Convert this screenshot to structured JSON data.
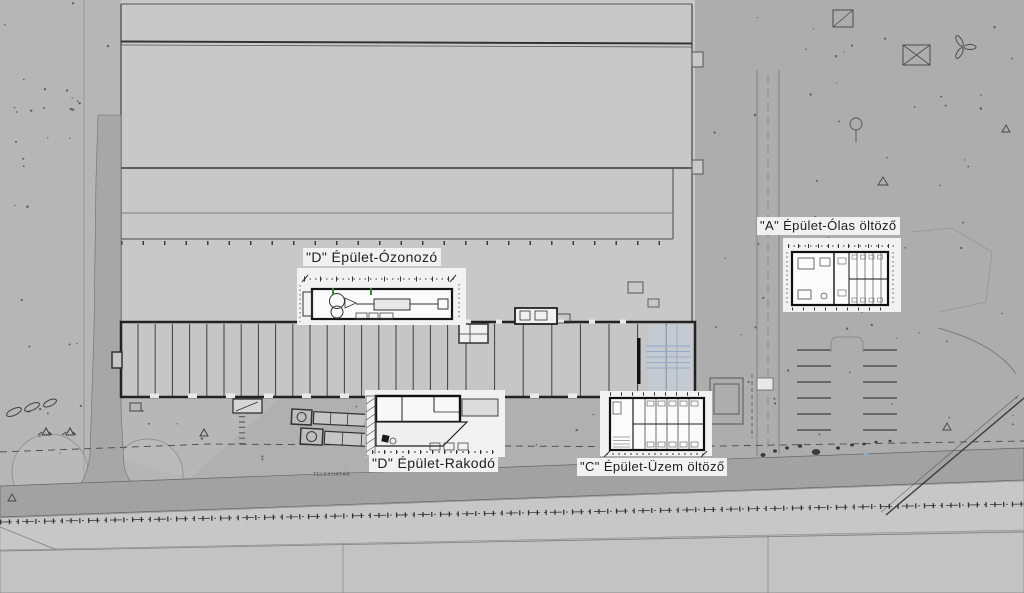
{
  "drawing": {
    "type": "architectural-site-plan",
    "callouts": [
      {
        "id": "ozonozo",
        "label": "\"D\" Épület-Ózonozó"
      },
      {
        "id": "rakodo",
        "label": "\"D\" Épület-Rakodó"
      },
      {
        "id": "uzem-oltozo",
        "label": "\"C\" Épület-Üzem öltöző"
      },
      {
        "id": "olas-oltozo",
        "label": "\"A\" Épület-Ólas öltöző"
      }
    ],
    "annotations": {
      "property_line": "TELEKHATÁR"
    },
    "colors": {
      "accent_blue_fill": "#c3cedb",
      "accent_blue_line": "#93abc7",
      "accent_green": "#2f8a2f",
      "paper": "#f2f2f2",
      "road": "#a2a2a2",
      "ink": "#222222"
    }
  }
}
